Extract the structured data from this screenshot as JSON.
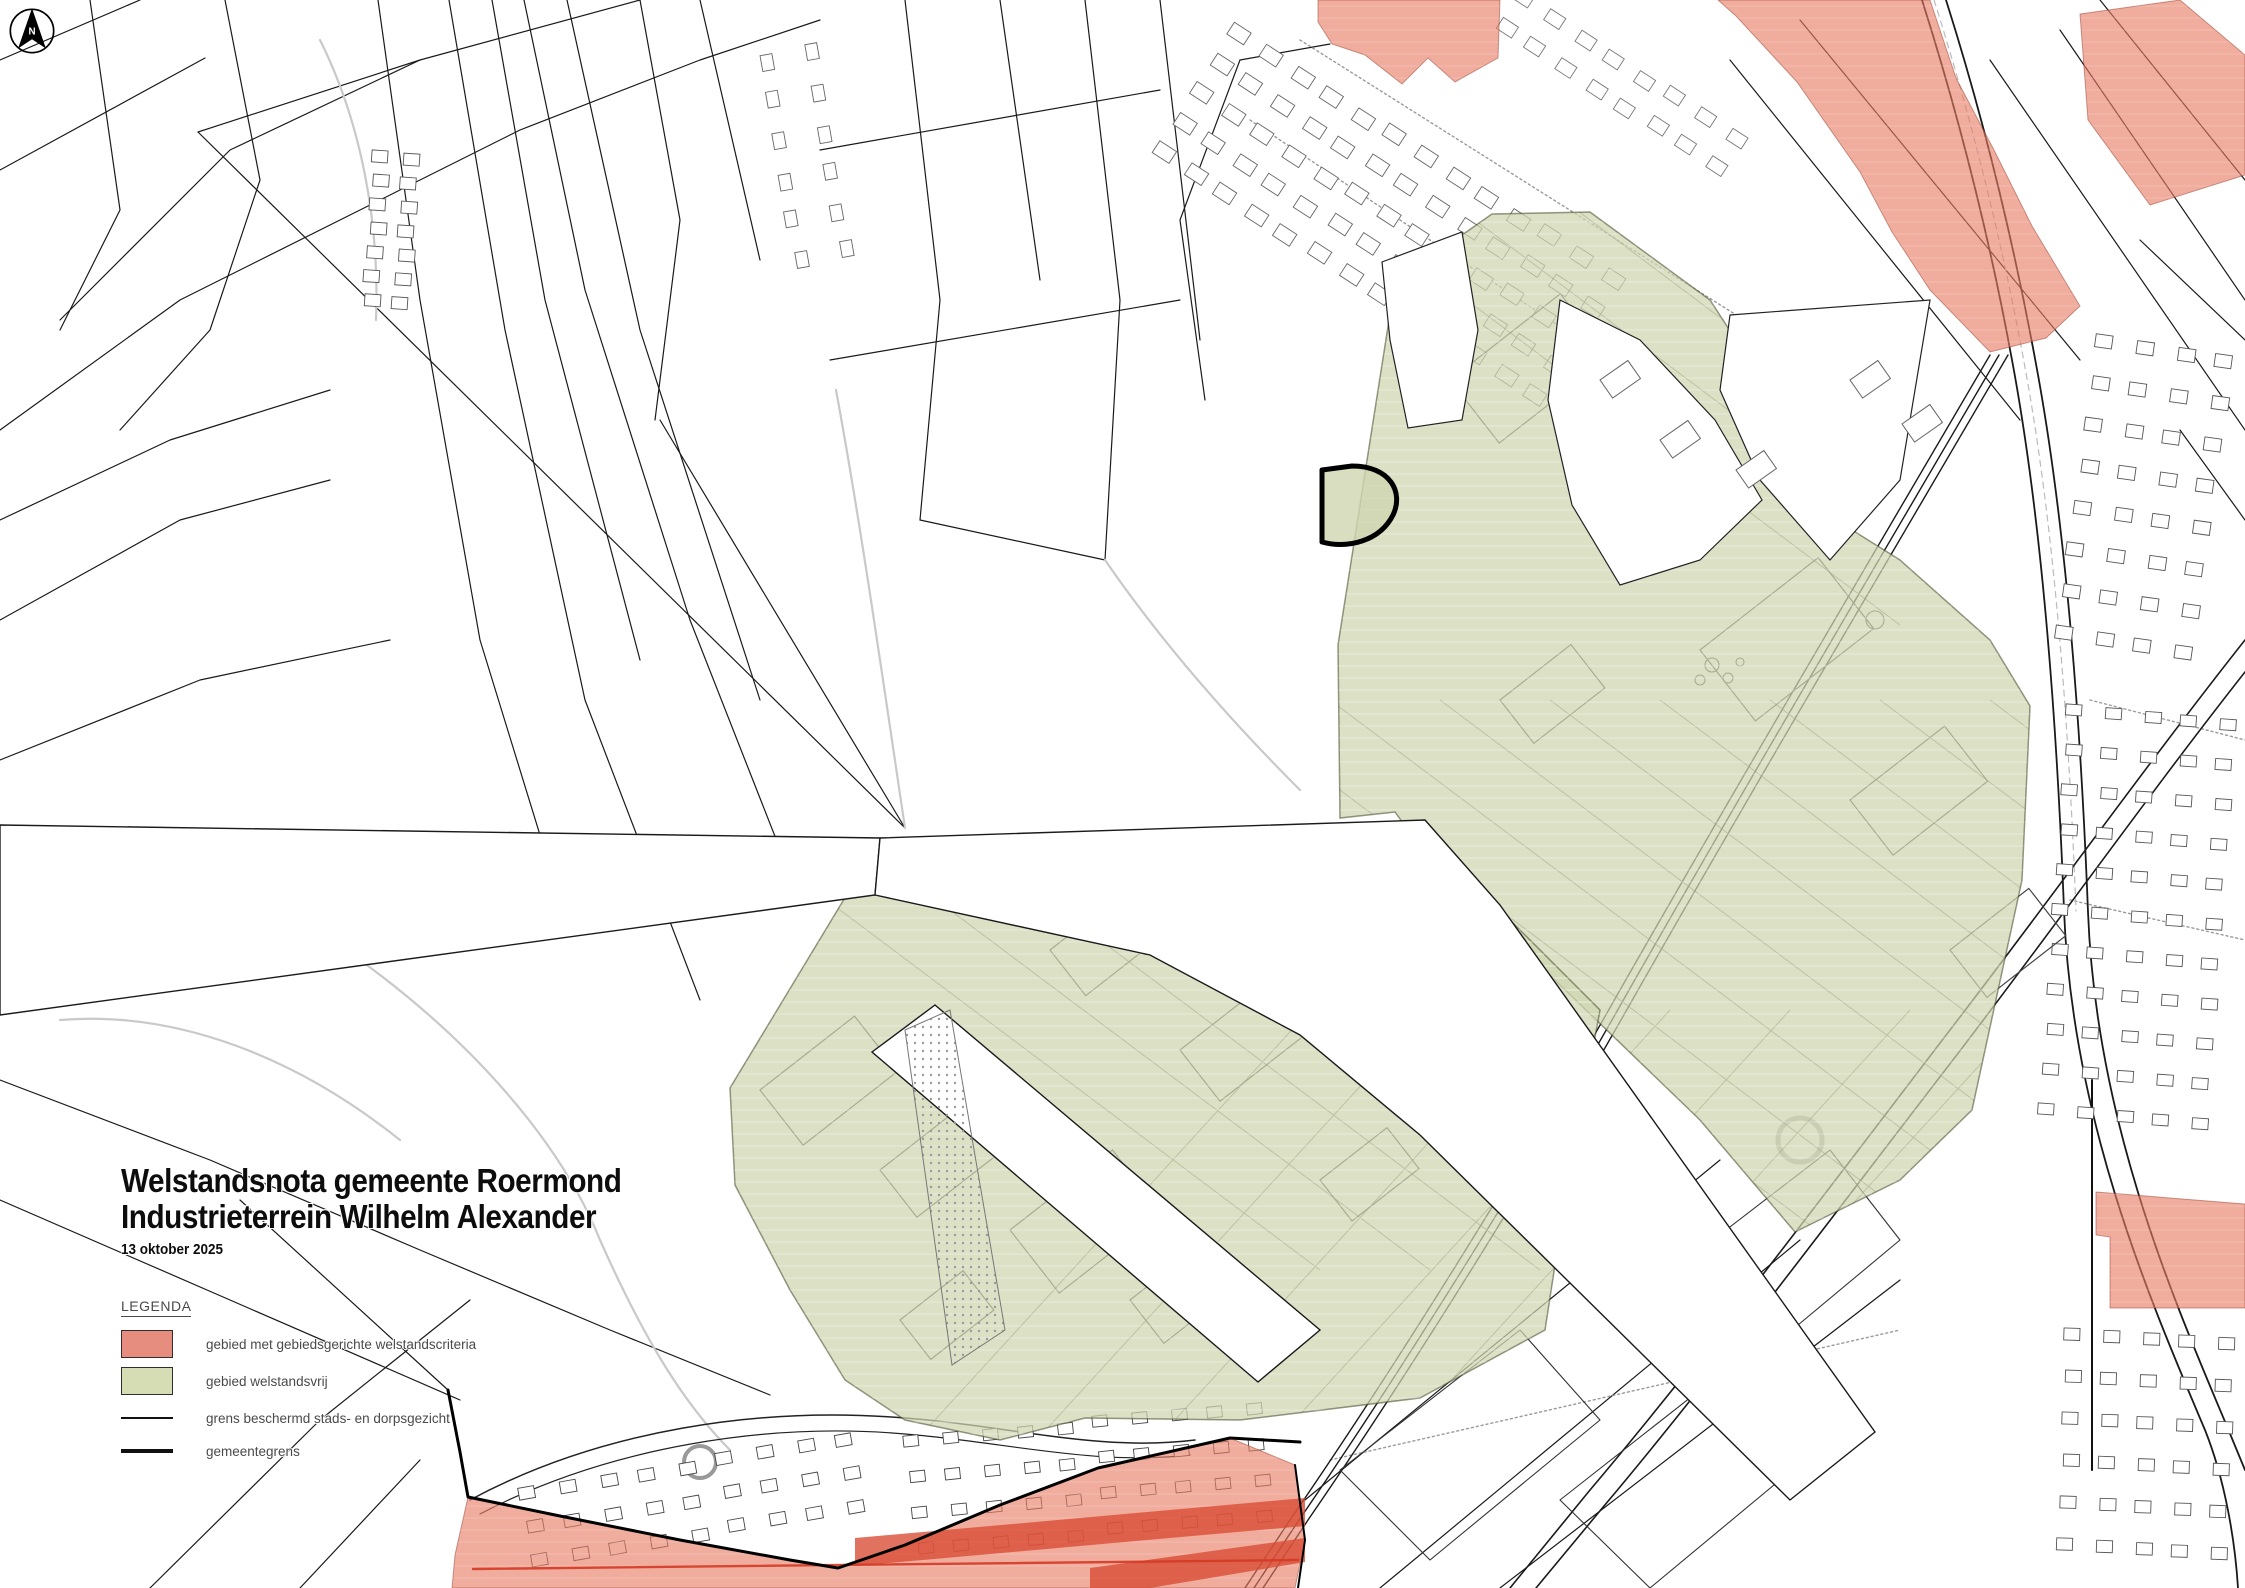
{
  "title": {
    "line1": "Welstandsnota gemeente Roermond",
    "line2": "Industrieterrein Wilhelm Alexander",
    "date": "13 oktober 2025"
  },
  "legend": {
    "heading": "LEGENDA",
    "items": [
      {
        "id": "red-area",
        "label": "gebied met gebiedsgerichte welstandscriteria"
      },
      {
        "id": "green-area",
        "label": "gebied welstandsvrij"
      },
      {
        "id": "protected-line",
        "label": "grens beschermd stads- en dorpsgezicht"
      },
      {
        "id": "municipal-line",
        "label": "gemeentegrens"
      }
    ]
  },
  "compass": {
    "label": "N"
  },
  "colors": {
    "red_zone": "#e7english7a63",
    "red_zone_fill": "#e77a63",
    "green_zone_fill": "#cfd6b0",
    "red_swatch": "#e78d7f",
    "green_swatch": "#d6ddb5",
    "zone_green_stroke": "#3f4525",
    "zone_red_stroke": "#8a2f1d",
    "stripe_red": "#d84a33",
    "accent_red_line": "#d43a24",
    "map_line": "#1a1a1a",
    "label_text": "#4a4a4a"
  }
}
